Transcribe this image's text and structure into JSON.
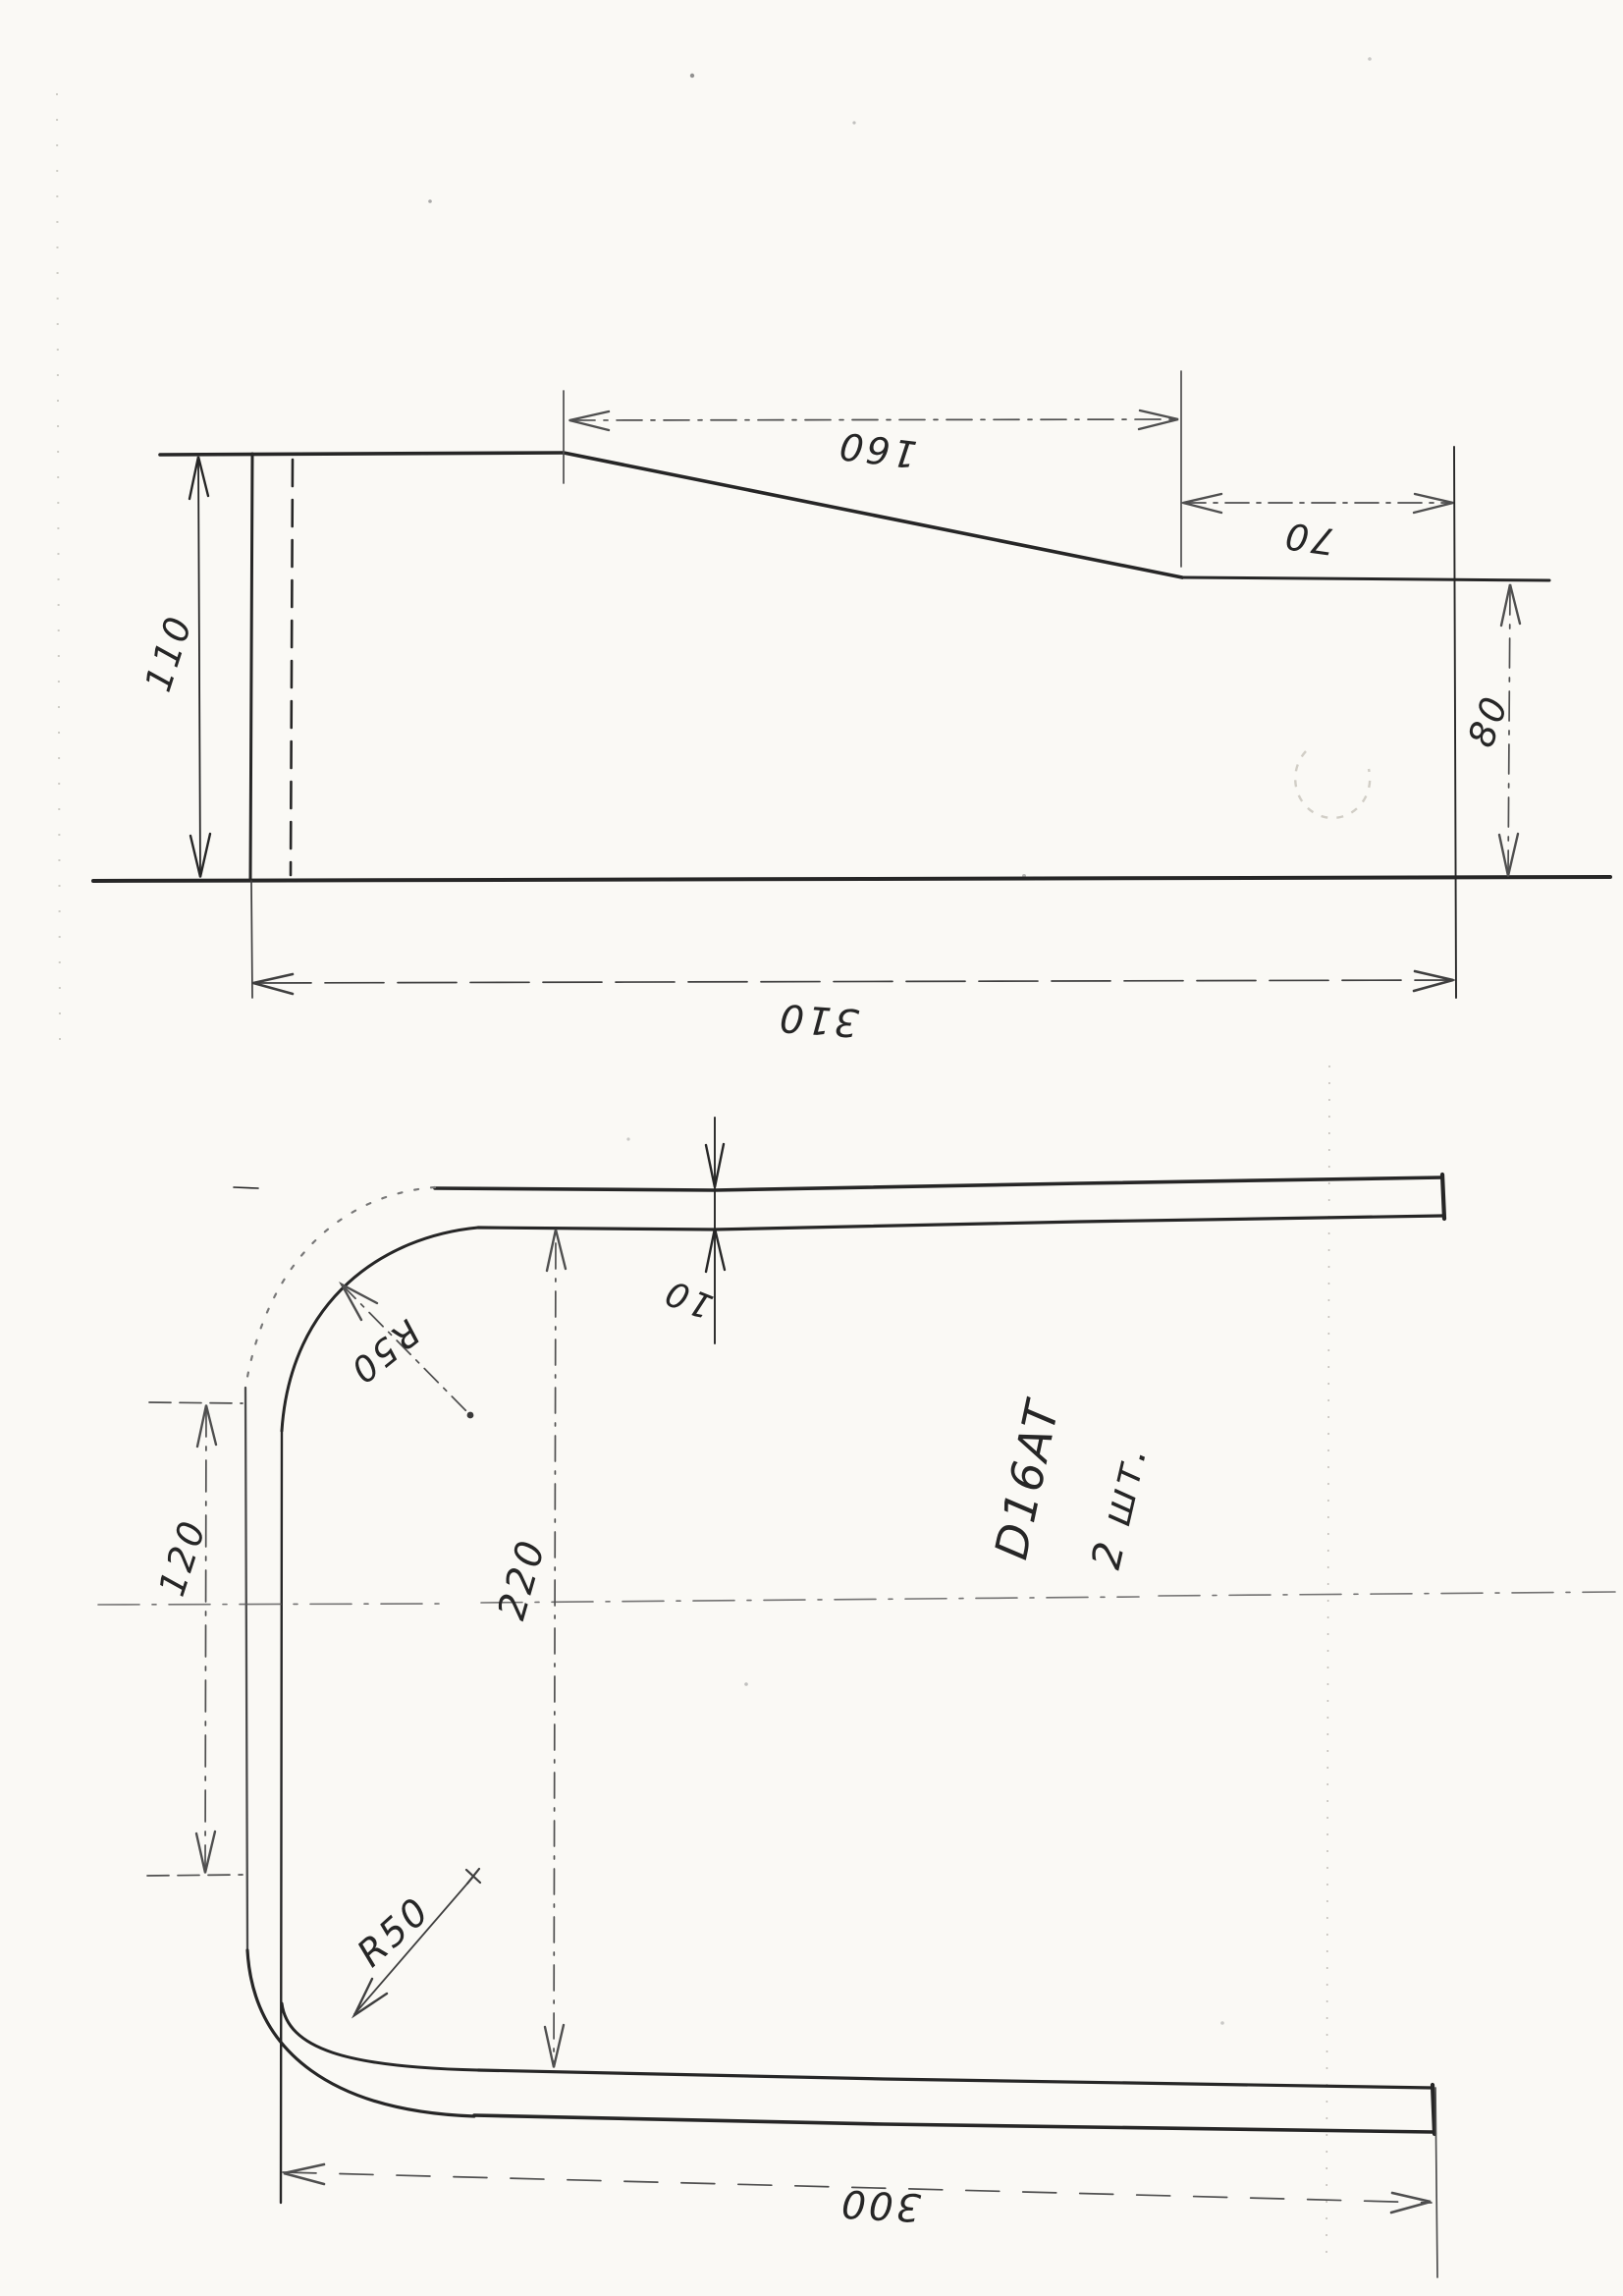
{
  "drawing": {
    "kind": "hand-drawn engineering sketch, scanned rotated 90 degrees",
    "top_view": {
      "dims": {
        "total_length": "310",
        "left_height": "110",
        "taper_length": "160",
        "right_flat": "70",
        "right_height": "80"
      }
    },
    "bottom_view": {
      "dims": {
        "thickness": "10",
        "straight_left": "120",
        "height": "220",
        "length": "300",
        "radius_top": "R50",
        "radius_bottom": "R50"
      },
      "notes": {
        "material": "D16AT",
        "quantity": "2 шт."
      }
    },
    "colors": {
      "paper": "#faf9f5",
      "ink": "#262626",
      "ink_light": "#6f6f6f",
      "artifact": "#9a968e"
    }
  }
}
